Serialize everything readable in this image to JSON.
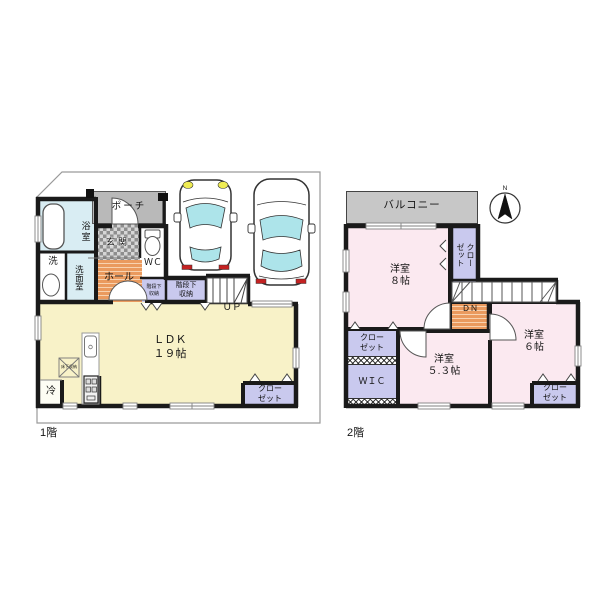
{
  "title": "間取り図",
  "colors": {
    "wall": "#1a1a1a",
    "ldk_yellow": "#f8f2c8",
    "room_pink": "#fbe9f0",
    "closet_purple": "#c9c9ee",
    "bath_cyan": "#d9edf3",
    "hall_orange": "#ea9a5e",
    "porch_gray": "#b9b9b9",
    "balcony_gray": "#c7c7c7",
    "glass_cyan": "#ade4ea",
    "taillight_red": "#c42222",
    "headlight_yellow": "#ededab"
  },
  "floor1": {
    "caption": "1階",
    "bath": "浴室",
    "laundry": "洗",
    "washroom": "洗面室",
    "porch": "ポーチ",
    "entrance": "玄関",
    "wc": "ＷＣ",
    "hall": "ホール",
    "stair_storage_small": "階段下\n収納",
    "stair_storage_large": "階段下\n収納",
    "up": "ＵＰ",
    "ldk": "ＬＤＫ\n１９帖",
    "floor_storage": "床下収納",
    "fridge": "冷",
    "closet": "クロー\nゼット"
  },
  "floor2": {
    "caption": "2階",
    "balcony": "バルコニー",
    "north": "N",
    "bedroom8": "洋室\n８帖",
    "closet_side": "クロー\nゼット",
    "down": "ＤＮ",
    "bedroom53": "洋室\n５.３帖",
    "bedroom6": "洋室\n６帖",
    "closet_left": "クロー\nゼット",
    "wic": "ＷＩＣ",
    "closet_br": "クロー\nゼット"
  }
}
